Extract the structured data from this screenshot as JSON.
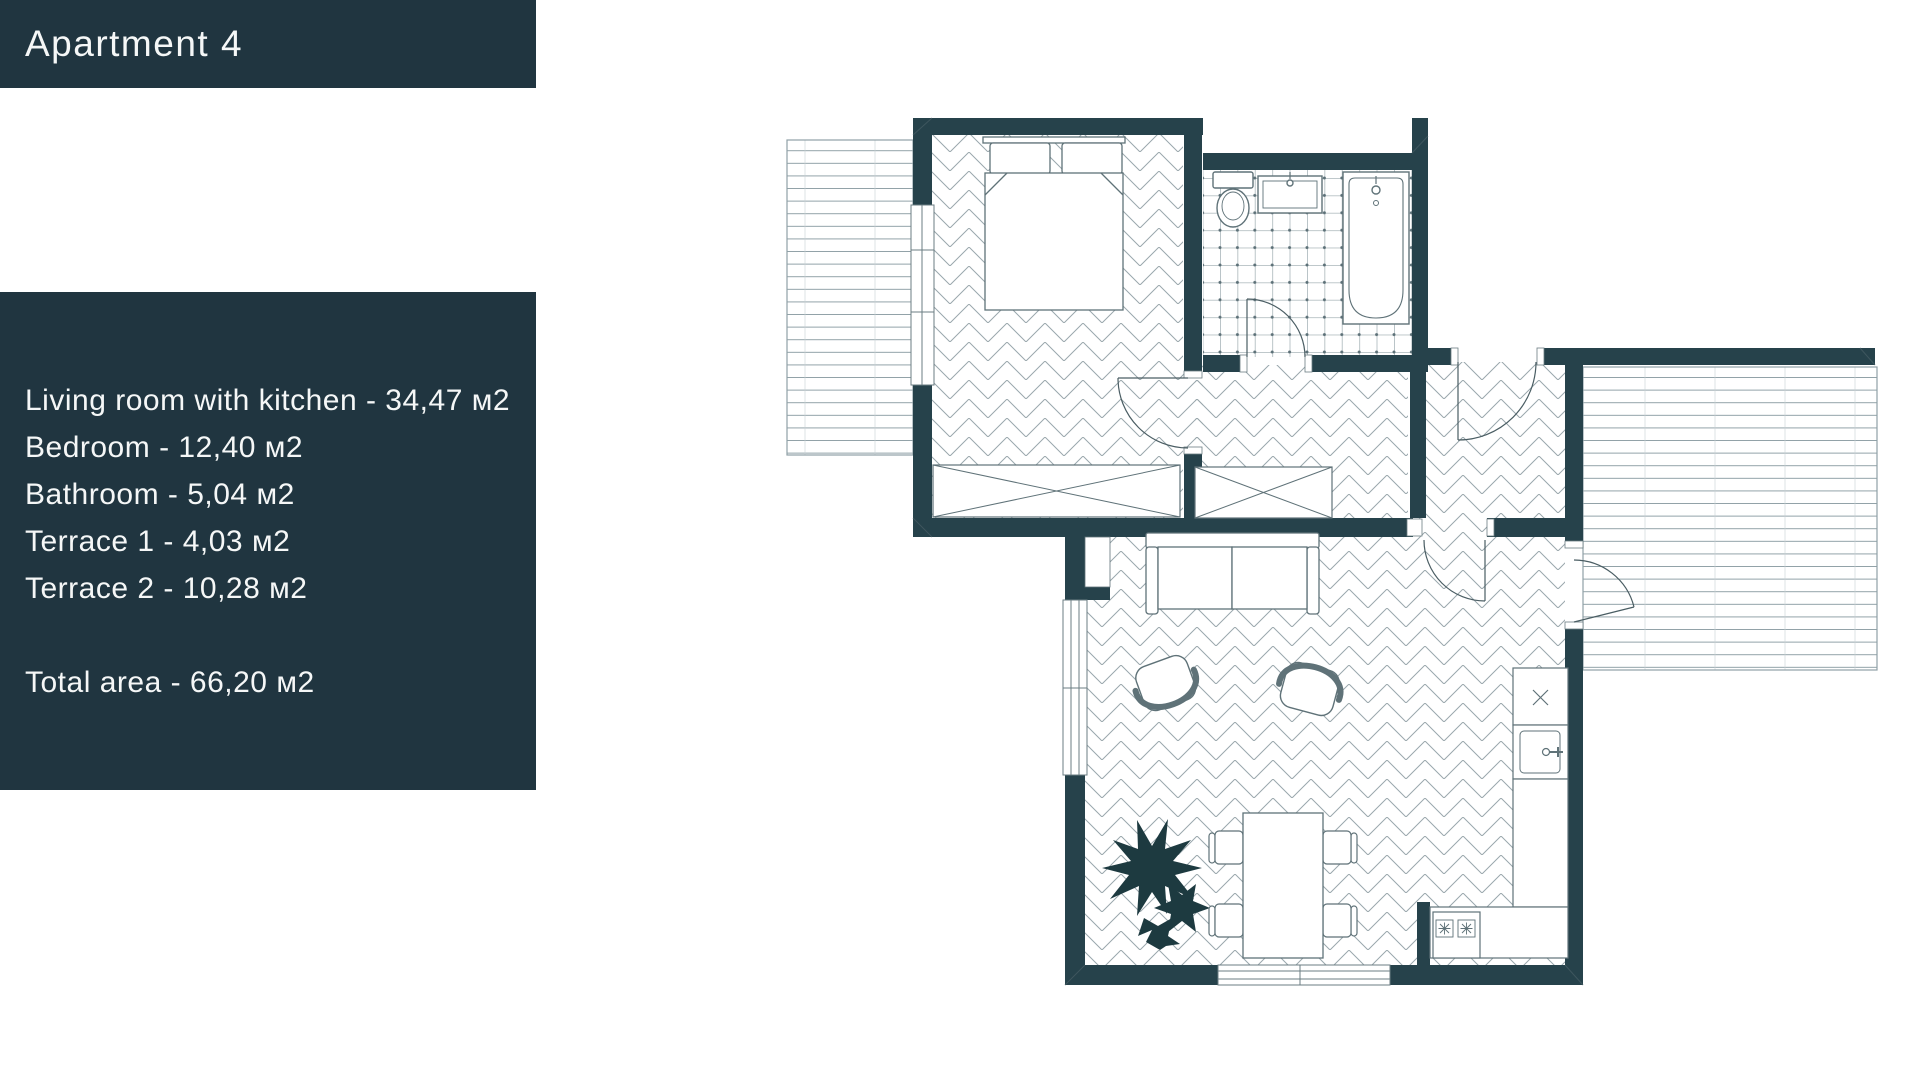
{
  "title": "Apartment 4",
  "areas": {
    "lines": [
      "Living room with kitchen - 34,47 м2",
      "Bedroom - 12,40 м2",
      "Bathroom - 5,04 м2",
      "Terrace 1 - 4,03 м2",
      "Terrace 2 - 10,28 м2"
    ],
    "total": "Total area - 66,20 м2"
  },
  "colors": {
    "panel": "#203540",
    "wall": "#26424b",
    "floor_line": "#9aa7ac",
    "deck_line": "#8fa0a6",
    "fixture_line": "#5f7278",
    "plant": "#1d3a40",
    "text": "#f5f7f7",
    "background": "#ffffff"
  }
}
